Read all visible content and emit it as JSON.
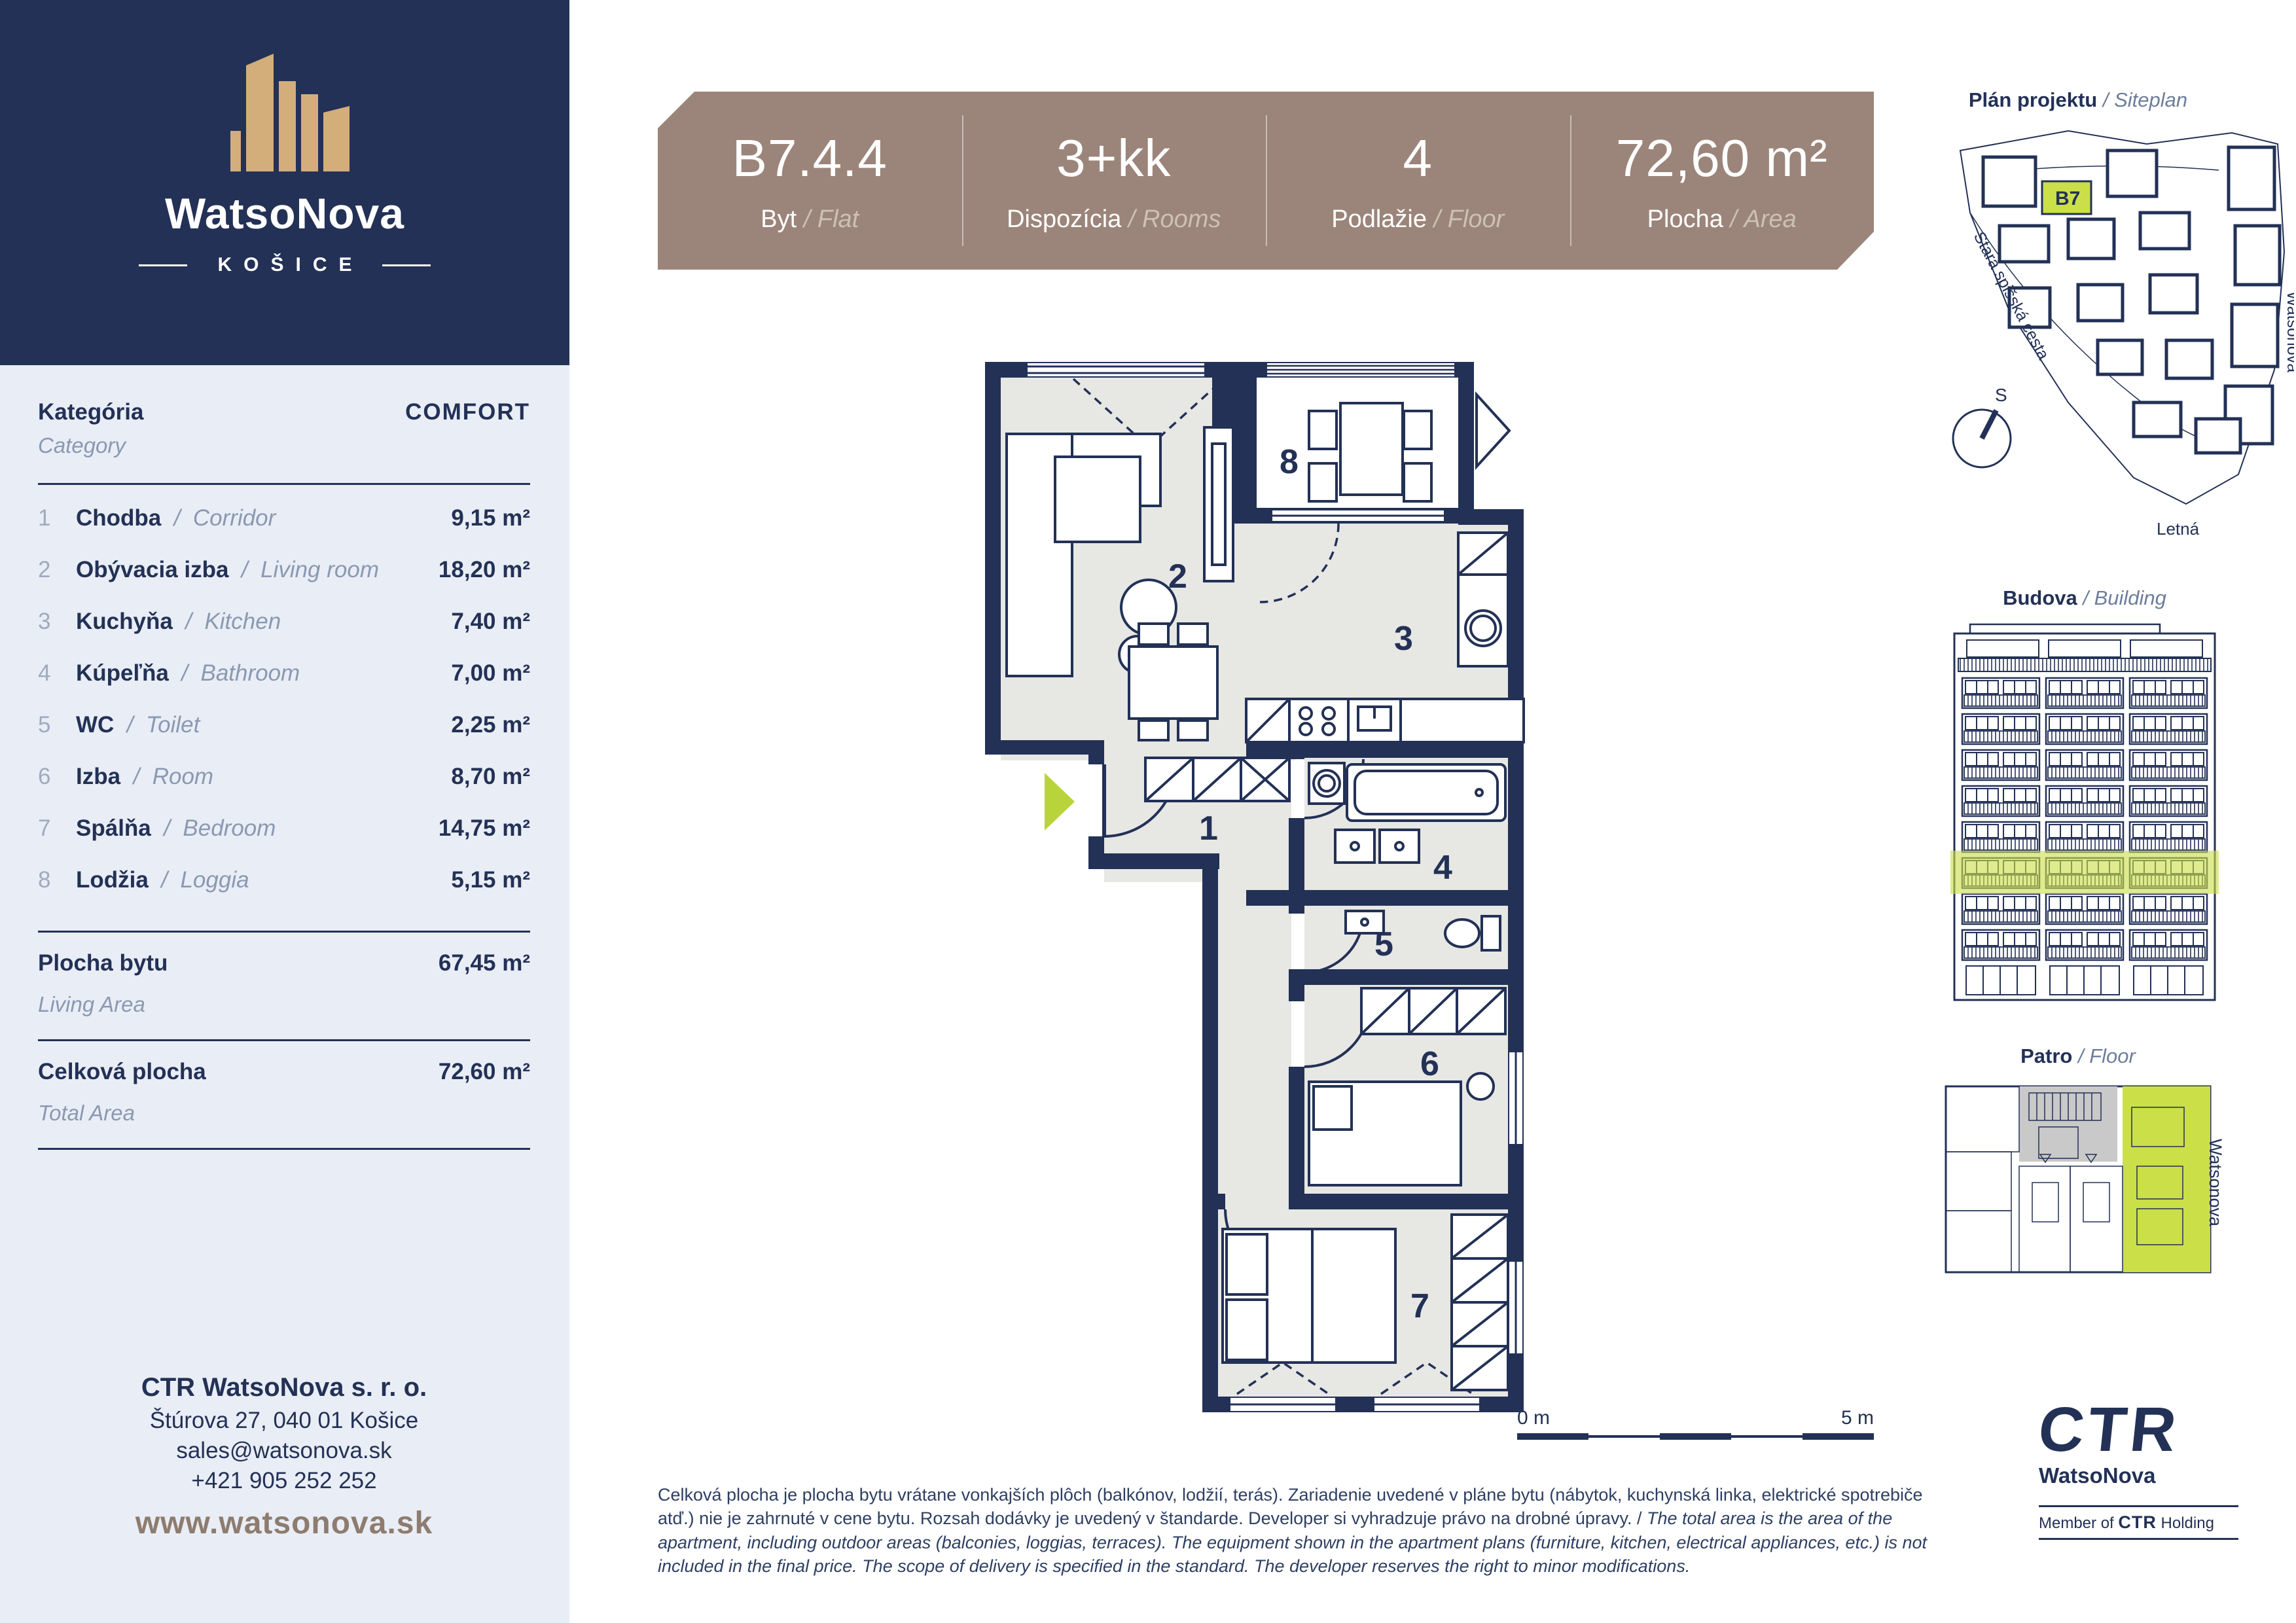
{
  "ui": {
    "slash": "/"
  },
  "brand": {
    "name": "WatsoNova",
    "city": "KOŠICE"
  },
  "sidebar": {
    "category_label_sk": "Kategória",
    "category_label_en": "Category",
    "category_value": "COMFORT",
    "rooms": [
      {
        "num": "1",
        "name_sk": "Chodba",
        "name_en": "Corridor",
        "area": "9,15 m²"
      },
      {
        "num": "2",
        "name_sk": "Obývacia izba",
        "name_en": "Living room",
        "area": "18,20 m²"
      },
      {
        "num": "3",
        "name_sk": "Kuchyňa",
        "name_en": "Kitchen",
        "area": "7,40 m²"
      },
      {
        "num": "4",
        "name_sk": "Kúpeľňa",
        "name_en": "Bathroom",
        "area": "7,00 m²"
      },
      {
        "num": "5",
        "name_sk": "WC",
        "name_en": "Toilet",
        "area": "2,25 m²"
      },
      {
        "num": "6",
        "name_sk": "Izba",
        "name_en": "Room",
        "area": "8,70 m²"
      },
      {
        "num": "7",
        "name_sk": "Spálňa",
        "name_en": "Bedroom",
        "area": "14,75 m²"
      },
      {
        "num": "8",
        "name_sk": "Lodžia",
        "name_en": "Loggia",
        "area": "5,15 m²"
      }
    ],
    "living_area_label_sk": "Plocha bytu",
    "living_area_label_en": "Living Area",
    "living_area_value": "67,45 m²",
    "total_area_label_sk": "Celková plocha",
    "total_area_label_en": "Total Area",
    "total_area_value": "72,60 m²",
    "contact_company": "CTR WatsoNova s. r. o.",
    "contact_address": "Štúrova 27, 040 01  Košice",
    "contact_email": "sales@watsonova.sk",
    "contact_phone": "+421 905 252 252",
    "website": "www.watsonova.sk"
  },
  "header": {
    "cells": [
      {
        "value": "B7.4.4",
        "label_sk": "Byt",
        "label_en": "Flat"
      },
      {
        "value": "3+kk",
        "label_sk": "Dispozícia",
        "label_en": "Rooms"
      },
      {
        "value": "4",
        "label_sk": "Podlažie",
        "label_en": "Floor"
      },
      {
        "value": "72,60 m²",
        "label_sk": "Plocha",
        "label_en": "Area"
      }
    ]
  },
  "floorplan": {
    "room_numbers": [
      "1",
      "2",
      "3",
      "4",
      "5",
      "6",
      "7",
      "8"
    ],
    "scale_start": "0 m",
    "scale_end": "5 m"
  },
  "panels": {
    "siteplan": {
      "title_sk": "Plán projektu",
      "title_en": "Siteplan",
      "highlight_label": "B7",
      "street_left": "Stará spišská cesta",
      "street_right": "Watsonova",
      "street_bottom": "Letná",
      "compass_label": "S"
    },
    "building": {
      "title_sk": "Budova",
      "title_en": "Building"
    },
    "floorplate": {
      "title_sk": "Patro",
      "title_en": "Floor",
      "street": "Watsonova"
    }
  },
  "footer": {
    "disclaimer_sk": "Celková plocha je plocha bytu vrátane vonkajších plôch (balkónov, lodžií, terás). Zariadenie uvedené v pláne bytu (nábytok, kuchynská linka, elektrické spotrebiče atď.) nie je zahrnuté v cene bytu. Rozsah dodávky je uvedený v štandarde. Developer si vyhradzuje právo na drobné úpravy.",
    "disclaimer_en": "The total area is the area of the apartment, including outdoor areas (balconies, loggias, terraces). The equipment shown in the apartment plans (furniture, kitchen, electrical appliances, etc.) is not included in the final price. The scope of delivery is specified in the standard. The developer reserves the right to minor modifications.",
    "ctr_logo": "CTR",
    "ctr_brand": "WatsoNova",
    "member_prefix": "Member of",
    "member_logo": "CTR",
    "member_suffix": "Holding"
  },
  "colors": {
    "navy": "#233156",
    "taupe": "#9b857a",
    "green": "#cbdf49",
    "light": "#e9edf5"
  }
}
